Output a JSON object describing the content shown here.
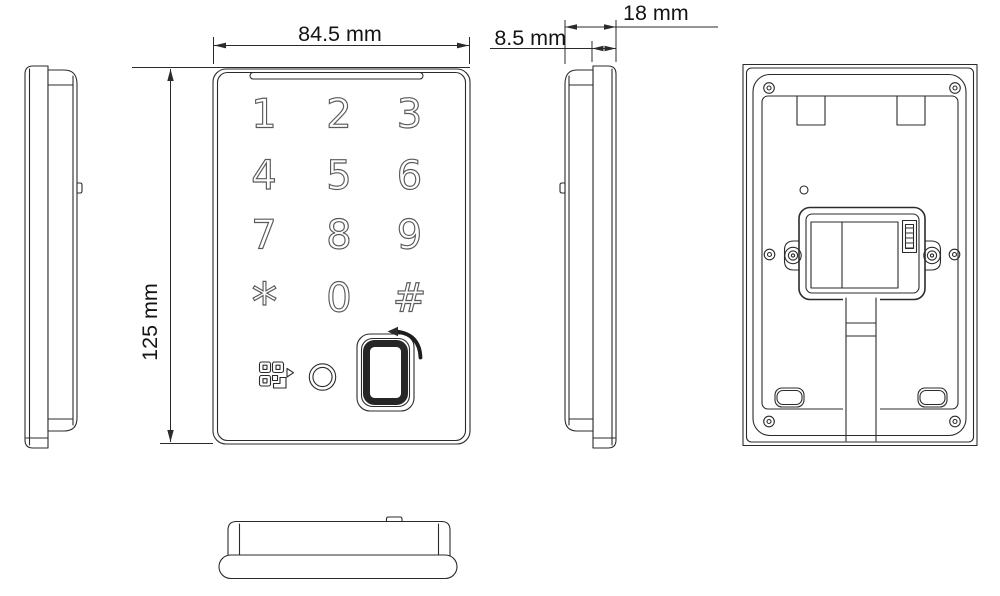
{
  "colors": {
    "background": "#ffffff",
    "line": "#2b2b2b",
    "key_outline": "#5a5a5a"
  },
  "dimensions": {
    "width": {
      "label": "84.5 mm"
    },
    "height": {
      "label": "125 mm"
    },
    "front_depth": {
      "label": "8.5 mm"
    },
    "total_depth": {
      "label": "18 mm"
    }
  },
  "keypad": {
    "keys": [
      "1",
      "2",
      "3",
      "4",
      "5",
      "6",
      "7",
      "8",
      "9",
      "*",
      "0",
      "#"
    ]
  }
}
